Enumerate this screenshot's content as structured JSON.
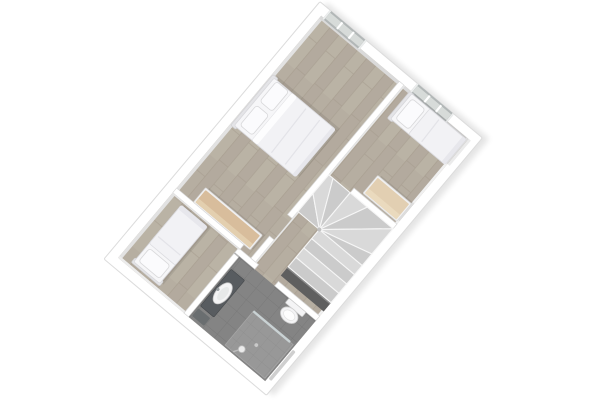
{
  "meta": {
    "description": "3D rendered top-down floor plan of an upper storey, rotated diagonally on a white background, no text labels",
    "rotation_deg": -50
  },
  "palette": {
    "background": "#ffffff",
    "wall": "#ffffff",
    "wall_edge": "#d7d7d7",
    "wall_face": "#e2e2e2",
    "wood_floor": "#b6aea1",
    "wood_floor_alt": "#b0a79a",
    "wood_floor_line": "#a59b8d",
    "bath_floor": "#848484",
    "bath_floor_line": "#757575",
    "shower_floor": "#989898",
    "shower_floor_line": "#8a8a8a",
    "bedding": "#f6f6f8",
    "bedding_shade": "#e7e7ec",
    "bed_outline": "#d5d5da",
    "headboard": "#e4e4e7",
    "pillow": "#fbfbfd",
    "wood_top": "#d8bd9c",
    "wood_top_light": "#e2cfb2",
    "furniture_white": "#f1f1f2",
    "window_frame": "#b2b7b7",
    "window_glass": "#d7dbd9",
    "counter_dark": "#585c60",
    "mirror_dark": "#6a6e70",
    "fixture_white": "#f4f4f5",
    "fixture_outline": "#cfcfcf",
    "stair_tread": "#d9d9d9",
    "stair_tread_alt": "#cbcbcb",
    "stair_edge": "#f6f6f6",
    "stair_void": "#5f5f5f",
    "rail_grey": "#cfcfcf",
    "glass_panel": "#ccd5d7",
    "drop_shadow": "#000000"
  },
  "floorplan": {
    "view": "winder staircase landing with three bedrooms and bathroom",
    "rooms": [
      {
        "name": "master-bedroom",
        "furniture": [
          "double-bed",
          "dresser"
        ],
        "windows": 1
      },
      {
        "name": "left-bedroom",
        "furniture": [
          "single-bed"
        ],
        "windows": 0
      },
      {
        "name": "right-bedroom",
        "furniture": [
          "single-bed",
          "desk"
        ],
        "windows": 1
      },
      {
        "name": "bathroom",
        "fixtures": [
          "vanity-sink",
          "mirror",
          "toilet",
          "shower"
        ],
        "windows": 0
      },
      {
        "name": "landing",
        "features": [
          "winder-staircase",
          "stair-void"
        ],
        "windows": 0
      }
    ],
    "window_count": 2,
    "staircase": "quarter-turn winder descending from landing"
  }
}
